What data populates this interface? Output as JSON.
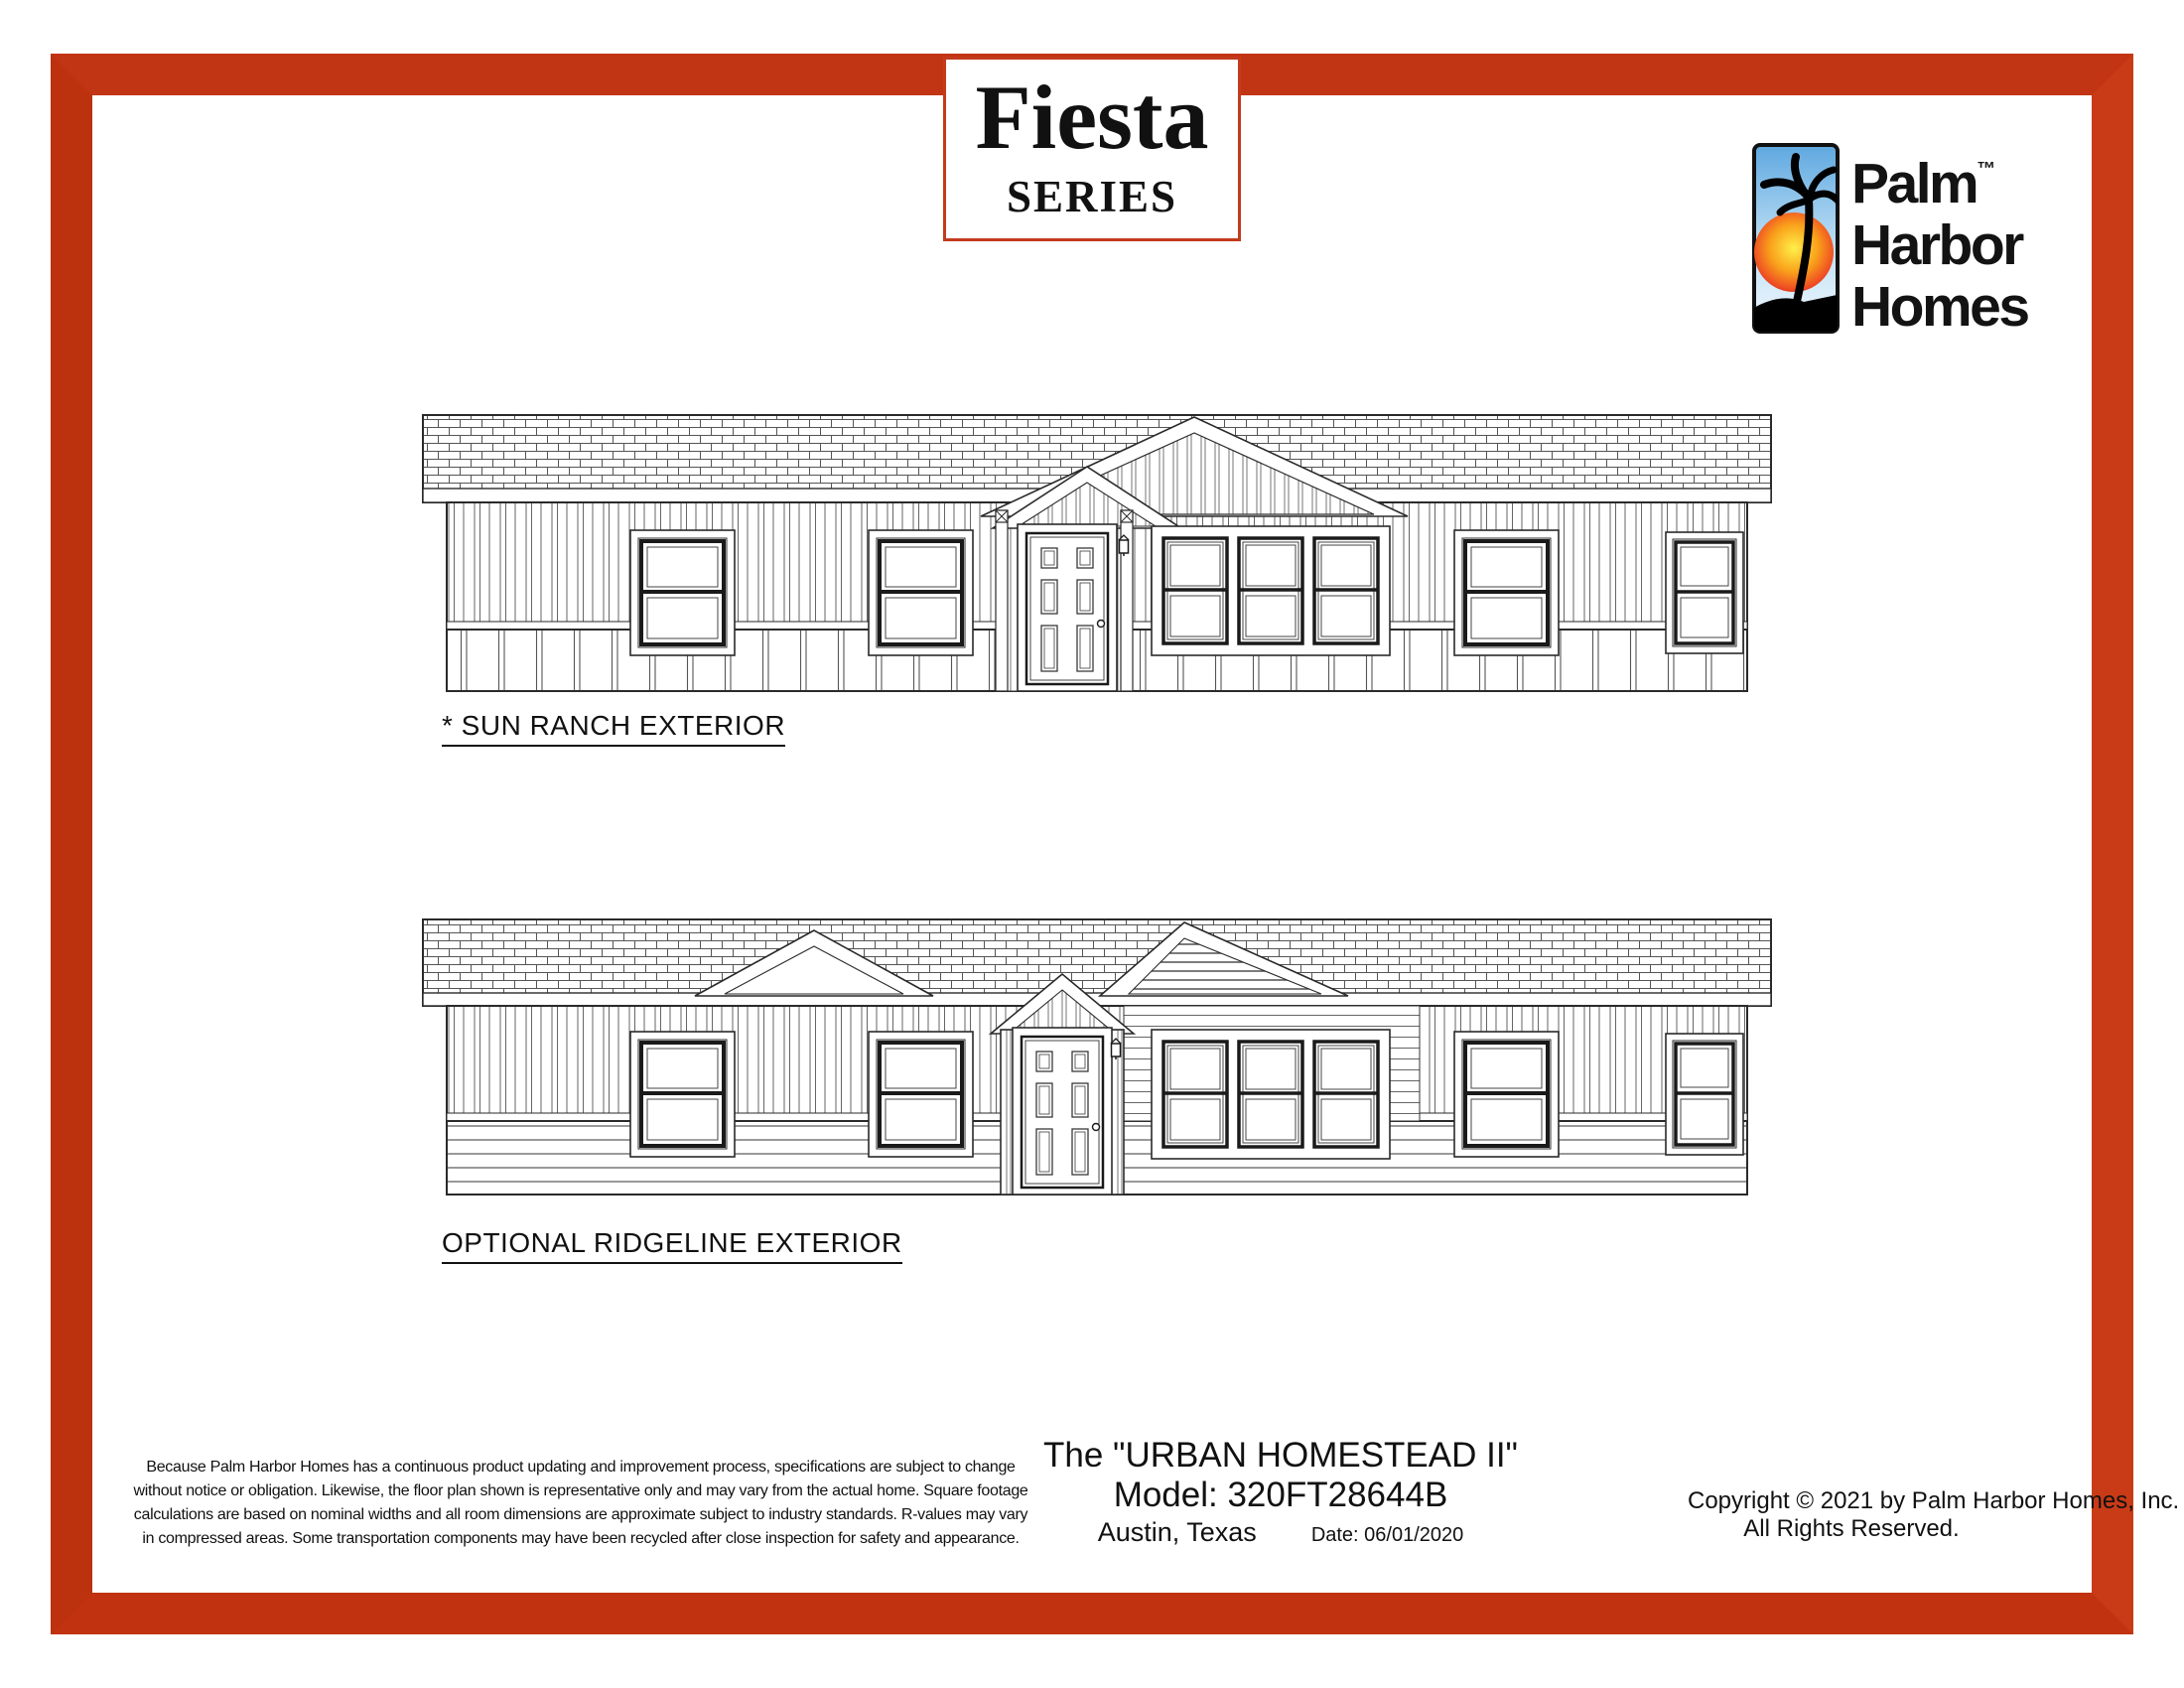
{
  "badge": {
    "title": "Fiesta",
    "subtitle": "SERIES"
  },
  "logo": {
    "word1": "Palm",
    "trademark": "™",
    "word2": "Harbor",
    "word3": "Homes"
  },
  "elevations": [
    {
      "label": "* SUN RANCH EXTERIOR"
    },
    {
      "label": "OPTIONAL RIDGELINE EXTERIOR"
    }
  ],
  "footer": {
    "disclaimer": {
      "lines": [
        "Because Palm Harbor Homes has a continuous product updating and improvement process, specifications are subject to change",
        "without notice or obligation. Likewise, the floor plan shown is representative only and may vary from the actual home. Square footage",
        "calculations are based on nominal widths and all room dimensions are approximate subject to industry standards. R-values may vary",
        "in compressed areas. Some transportation components may have been recycled after close inspection for safety and appearance."
      ]
    },
    "model": {
      "name": "The \"URBAN HOMESTEAD II\"",
      "number": "Model: 320FT28644B",
      "location": "Austin, Texas",
      "date": "Date: 06/01/2020"
    },
    "copyright": {
      "line1": "Copyright © 2021 by Palm Harbor Homes, Inc.",
      "line2": "All Rights Reserved."
    }
  },
  "colors": {
    "frame_red": "#c23514",
    "ink": "#1a1a1a"
  }
}
